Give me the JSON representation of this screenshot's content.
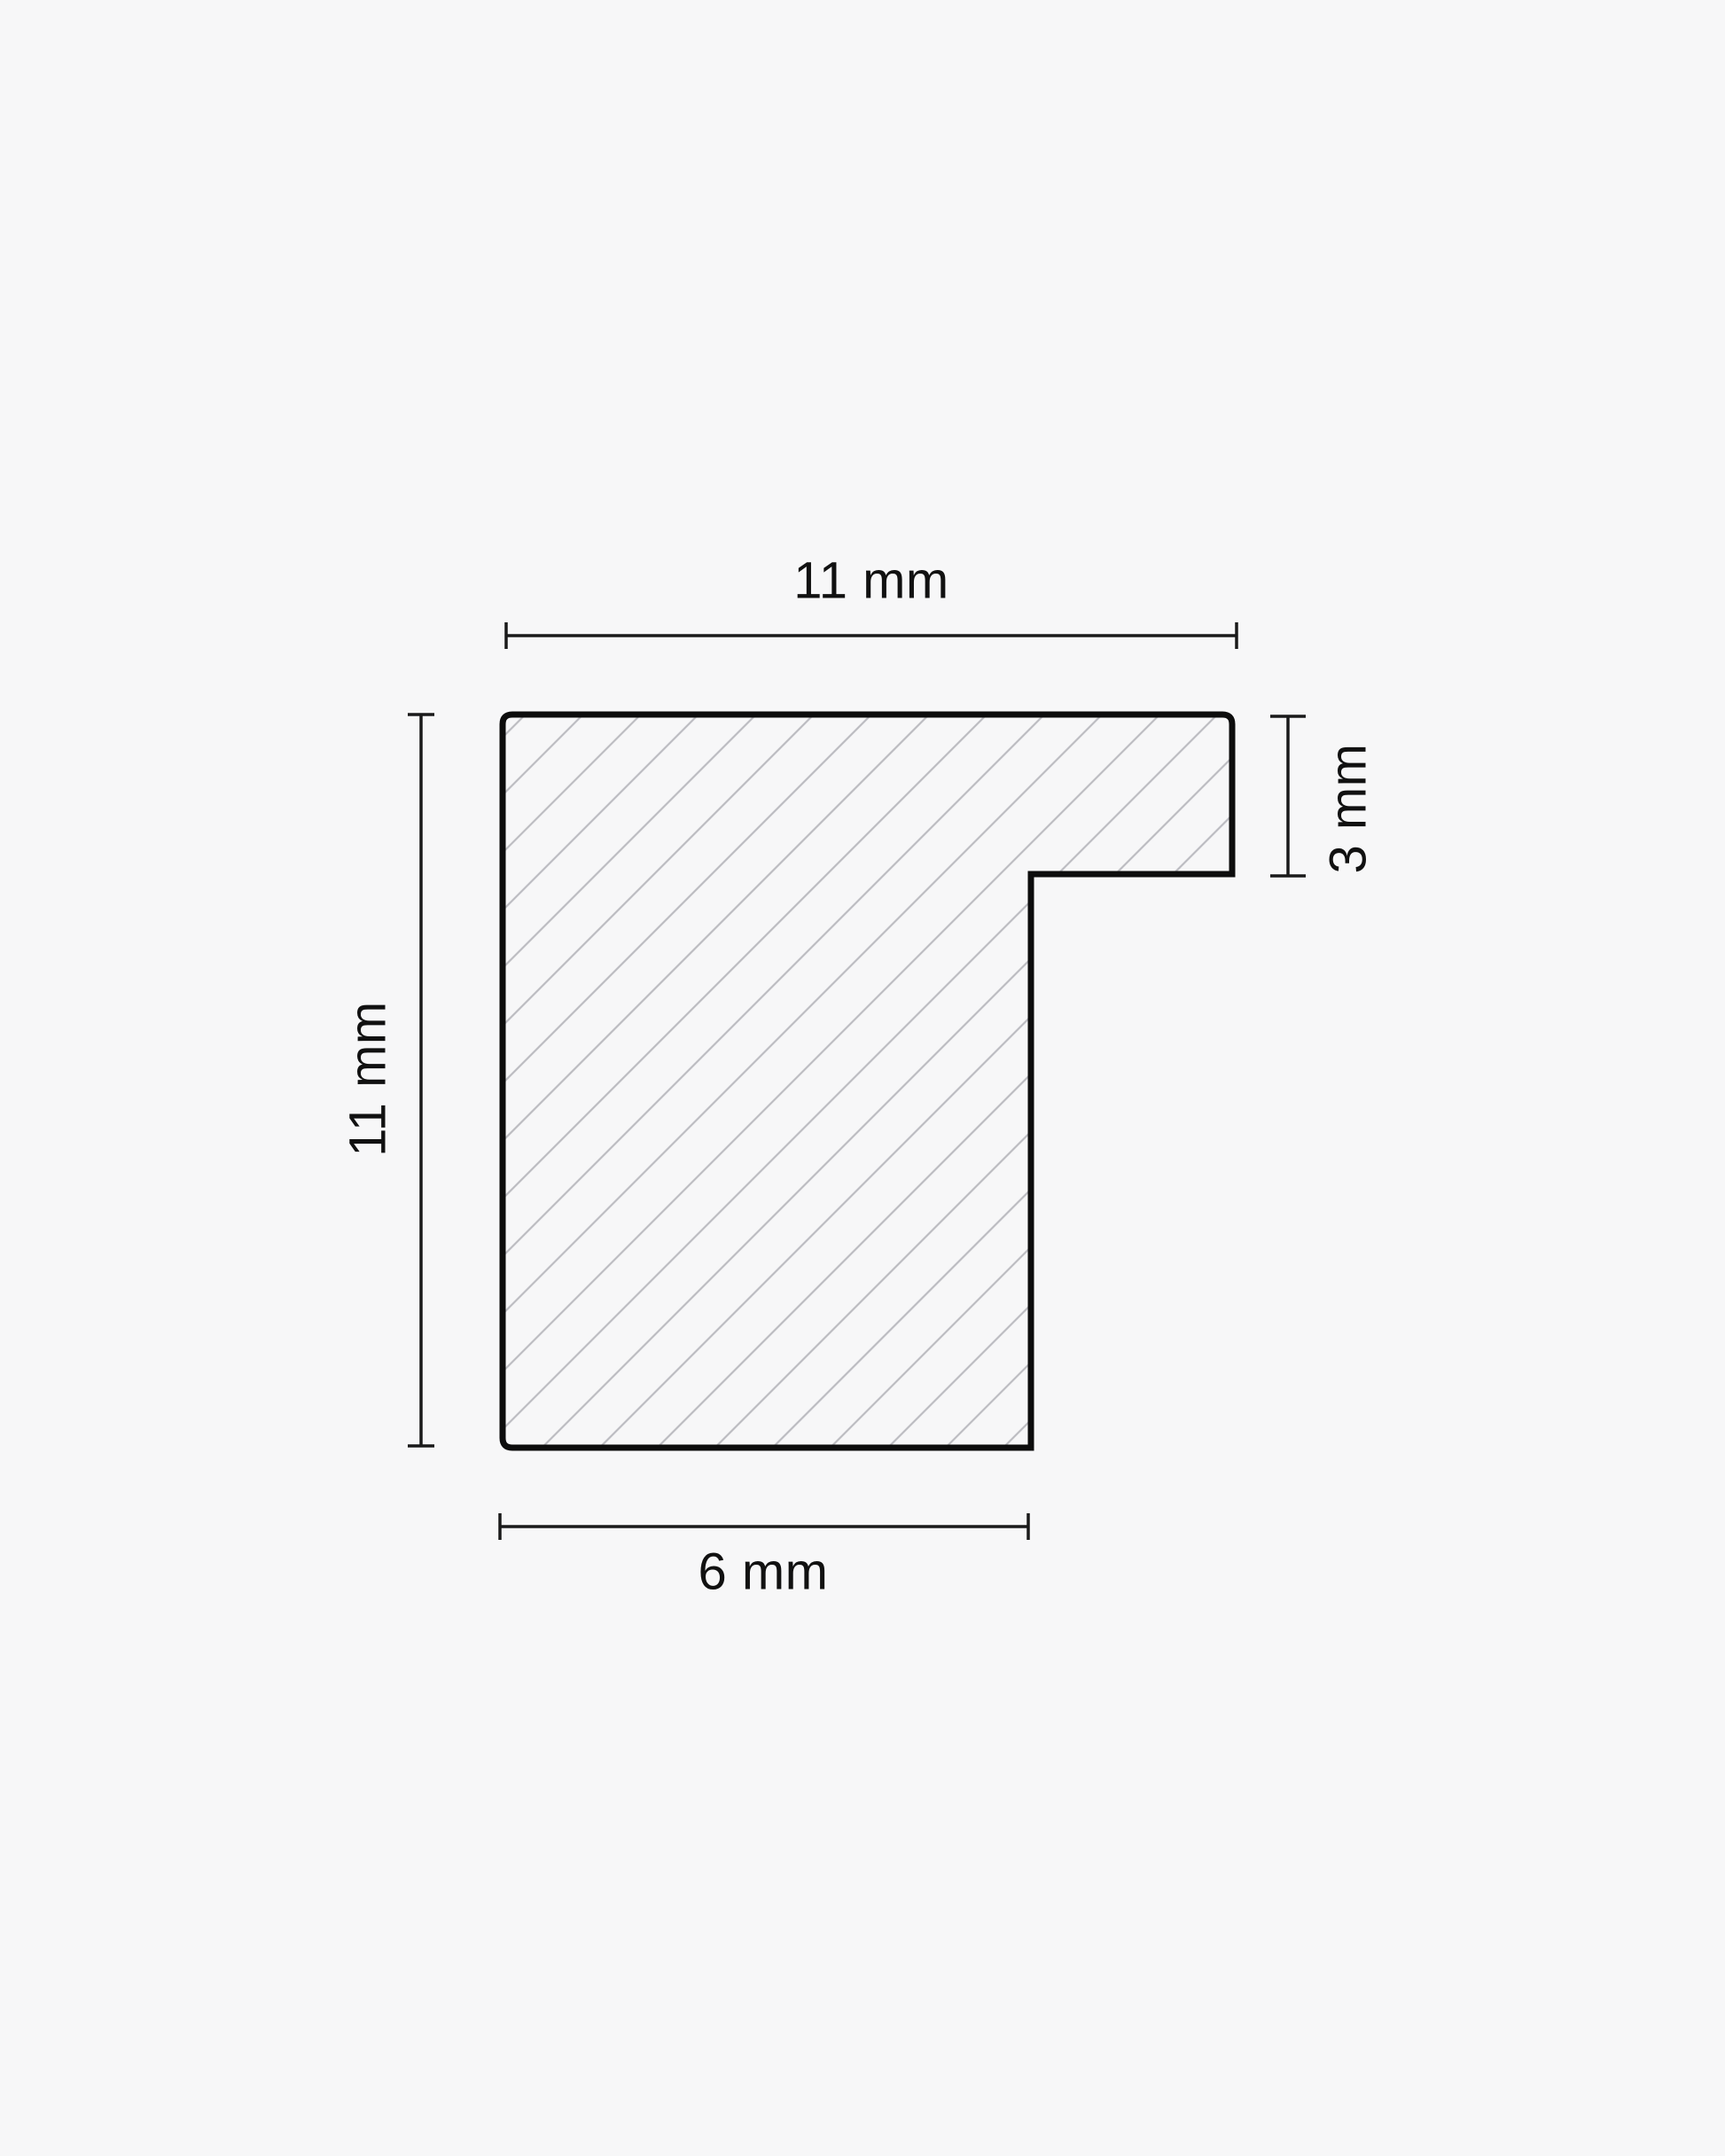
{
  "diagram": {
    "title": "frame-moulding-cross-section",
    "unit": "mm",
    "dimensions": {
      "top": {
        "label": "11 mm",
        "value": 11,
        "edge": "overall width"
      },
      "left": {
        "label": "11 mm",
        "value": 11,
        "edge": "overall height"
      },
      "right": {
        "label": "3 mm",
        "value": 3,
        "edge": "rabbet lip height"
      },
      "bottom": {
        "label": "6 mm",
        "value": 6,
        "edge": "lower leg width"
      }
    },
    "colors": {
      "background": "#f7f7f8",
      "outline": "#0d0d0d",
      "dimension_line": "#1a1a1a",
      "hatch": "#bcbcc1",
      "text": "#111111"
    }
  }
}
